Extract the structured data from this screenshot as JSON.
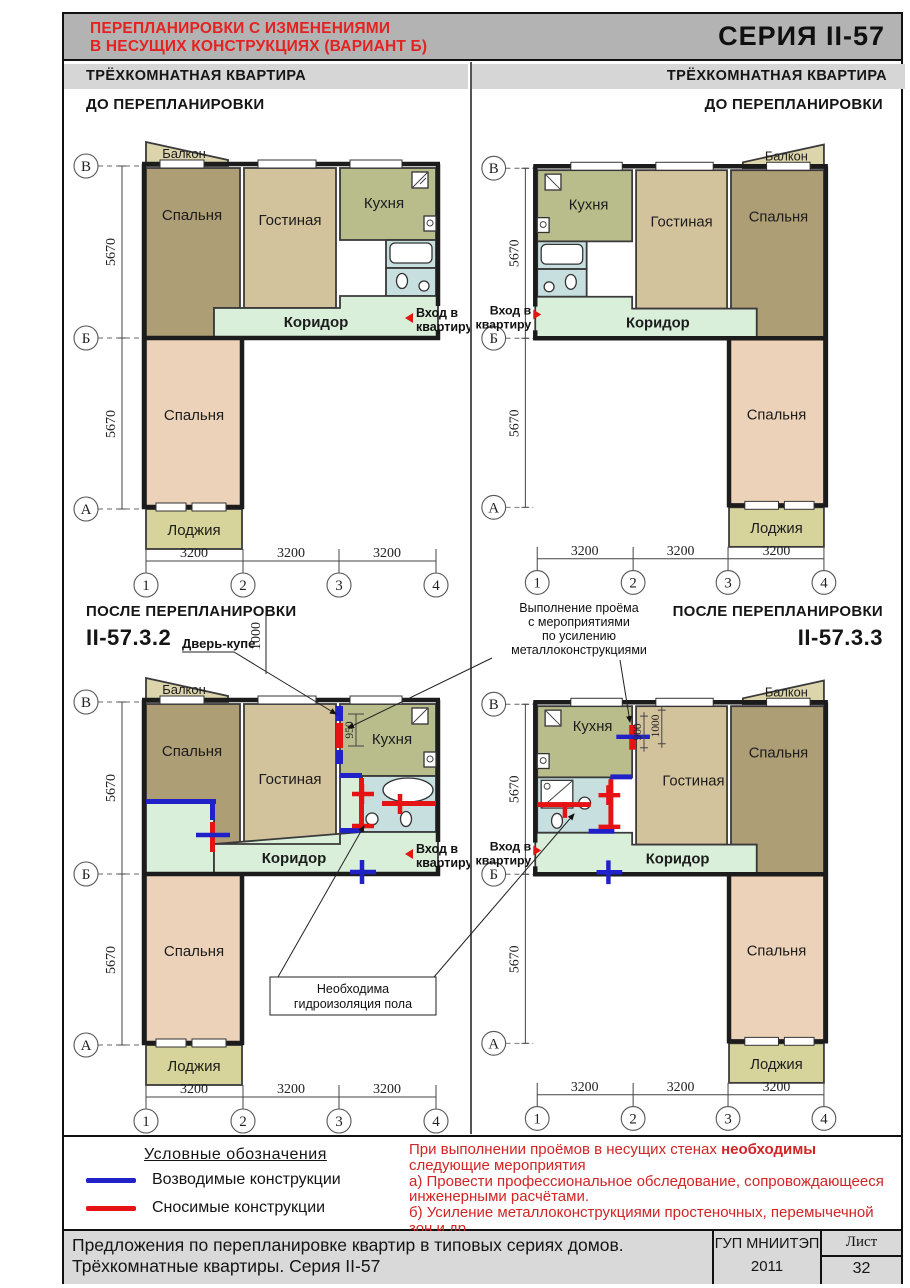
{
  "header": {
    "title_line1": "ПЕРЕПЛАНИРОВКИ С ИЗМЕНЕНИЯМИ",
    "title_line2": "В НЕСУЩИХ КОНСТРУКЦИЯХ (ВАРИАНТ Б)",
    "series": "СЕРИЯ  II-57"
  },
  "sections": {
    "left_apartment": "ТРЁХКОМНАТНАЯ  КВАРТИРА",
    "right_apartment": "ТРЁХКОМНАТНАЯ КВАРТИРА",
    "before_left": "ДО ПЕРЕПЛАНИРОВКИ",
    "before_right": "ДО ПЕРЕПЛАНИРОВКИ",
    "after_left": "ПОСЛЕ ПЕРЕПЛАНИРОВКИ",
    "after_right": "ПОСЛЕ ПЕРЕПЛАНИРОВКИ",
    "code_left": "II-57.3.2",
    "code_right": "II-57.3.3"
  },
  "rooms": {
    "bedroom": "Спальня",
    "living": "Гостиная",
    "kitchen": "Кухня",
    "corridor": "Коридор",
    "balcony": "Балкон",
    "loggia": "Лоджия"
  },
  "entry": {
    "line1": "Вход в",
    "line2": "квартиру"
  },
  "axes": {
    "v": "В",
    "b": "Б",
    "a": "А",
    "c1": "1",
    "c2": "2",
    "c3": "3",
    "c4": "4"
  },
  "dims": {
    "w": "3200",
    "h": "5670",
    "d950": "950",
    "d900": "900",
    "d1000": "1000"
  },
  "annotations": {
    "sliding_door": "Дверь-купе",
    "opening_l1": "Выполнение проёма",
    "opening_l2": "с мероприятиями",
    "opening_l3": "по усилению",
    "opening_l4": "металлоконструкциями",
    "waterproof_l1": "Необходима",
    "waterproof_l2": "гидроизоляция пола"
  },
  "legend": {
    "title": "Условные  обозначения",
    "new_walls": "Возводимые конструкции",
    "demolished_walls": "Сносимые    конструкции",
    "colors": {
      "new": "#2121c8",
      "demolished": "#e51313"
    }
  },
  "note": {
    "l1_normal": "При выполнении проёмов в несущих стенах ",
    "l1_bold": "необходимы",
    "l2": "следующие мероприятия",
    "item_a1": "а) Провести профессиональное обследование, сопровождающееся",
    "item_a2": "инженерными расчётами.",
    "item_b1": "б) Усиление металлоконструкциями простеночных, перемычечной",
    "item_b2": "зон и др."
  },
  "footer": {
    "title_line1": "Предложения по перепланировке квартир в типовых сериях домов.",
    "title_line2": "Трёхкомнатные квартиры. Серия II-57",
    "organization": "ГУП МНИИТЭП",
    "year": "2011",
    "sheet_label": "Лист",
    "sheet_number": "32"
  }
}
